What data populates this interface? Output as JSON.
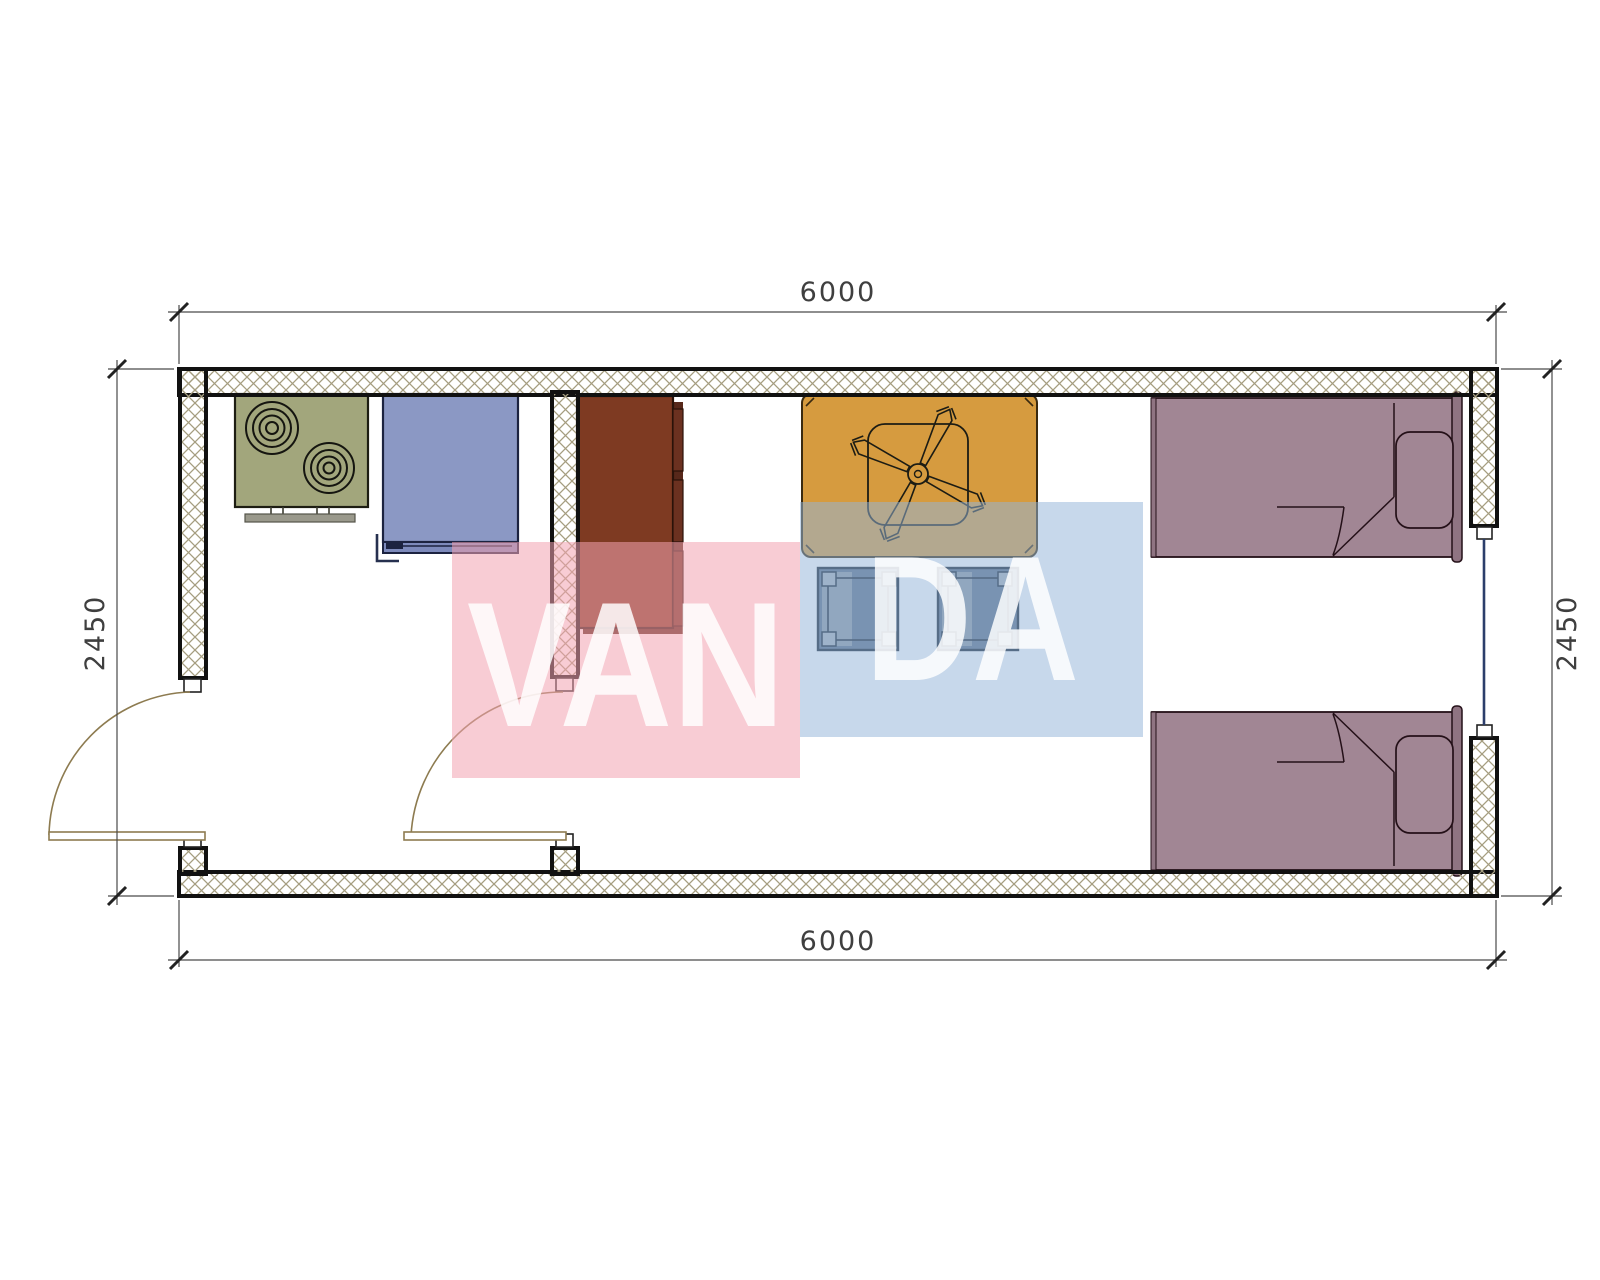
{
  "document": {
    "type": "architectural-floor-plan",
    "subject": "single-module container house plan with kitchen, wardrobe, dining table, stools and two single beds"
  },
  "dimensions": {
    "top": "6000",
    "bottom": "6000",
    "left": "2450",
    "right": "2450"
  },
  "watermark": {
    "text": "VANDA",
    "segment_pink": "VAN",
    "segment_blue": "DA",
    "pink_square_color": "#f2a3b1",
    "blue_square_color": "#94b5d8",
    "letter_color": "#ffffff"
  },
  "furniture": {
    "items": [
      "cooktop-2-burner",
      "refrigerator",
      "wardrobe",
      "dining-table",
      "ceiling-fan",
      "stool",
      "stool",
      "single-bed",
      "single-bed"
    ],
    "openings": {
      "doors": 2,
      "windows": 1
    }
  },
  "colors": {
    "wall_line": "#111111",
    "hatch_line": "#a59d80",
    "cooktop": "#a2a67c",
    "refrigerator": "#8b98c4",
    "wardrobe": "#7e3a22",
    "table": "#d69b3f",
    "stool": "#5d7088",
    "bed": "#a18694",
    "door_arc": "#8d7b50",
    "window_line": "#2c3e6b",
    "dimension_line": "#4a4a4a"
  }
}
